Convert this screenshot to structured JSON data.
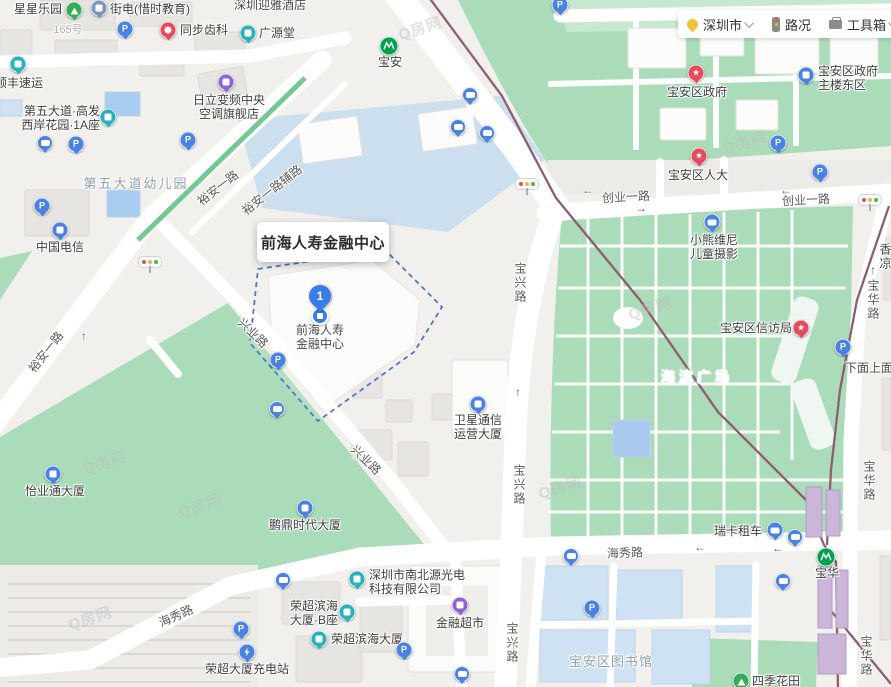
{
  "toolbar": {
    "city": "深圳市",
    "traffic_label": "路况",
    "toolbox_label": "工具箱"
  },
  "popup": {
    "title": "前海人寿金融中心"
  },
  "main_pin": {
    "number": "1",
    "label": [
      "前海人寿",
      "金融中心"
    ]
  },
  "watermark": {
    "text": "Q房网"
  },
  "glyphs": {
    "parking": "P",
    "star": "★"
  },
  "colors": {
    "green": "#35ab58",
    "teal": "#29b0bd",
    "red": "#e84a5c",
    "purple": "#8f63d2",
    "blue": "#4a82e4",
    "slate": "#7e95c2",
    "metro_green": "#00a14e",
    "park": "#abdcba",
    "metro_line": "#8e5d6e",
    "boundary": "#4f78cc",
    "blue_building": "#cfe2f4"
  },
  "metro": [
    {
      "name": "宝安",
      "x": 389,
      "y": 46
    },
    {
      "name": "宝华",
      "x": 826,
      "y": 557
    }
  ],
  "road_labels": [
    {
      "t": "裕安一路",
      "x": 218,
      "y": 188,
      "r": -38
    },
    {
      "t": "裕安一路辅路",
      "x": 272,
      "y": 190,
      "r": -38
    },
    {
      "t": "裕安一路",
      "x": 46,
      "y": 352,
      "r": -52
    },
    {
      "t": "兴业路",
      "x": 253,
      "y": 333,
      "r": 44
    },
    {
      "t": "兴业路",
      "x": 366,
      "y": 460,
      "r": 44
    },
    {
      "t": "宝兴路",
      "x": 520,
      "y": 283,
      "v": 1
    },
    {
      "t": "宝兴路",
      "x": 519,
      "y": 485,
      "v": 1
    },
    {
      "t": "宝兴路",
      "x": 512,
      "y": 643,
      "v": 1
    },
    {
      "t": "创业一路",
      "x": 626,
      "y": 197,
      "r": -3
    },
    {
      "t": "创业一路",
      "x": 806,
      "y": 200,
      "r": -3
    },
    {
      "t": "海秀路",
      "x": 176,
      "y": 616,
      "r": -24
    },
    {
      "t": "海秀路",
      "x": 625,
      "y": 553,
      "r": -2
    },
    {
      "t": "宝华路",
      "x": 873,
      "y": 300,
      "v": 1
    },
    {
      "t": "宝华路",
      "x": 869,
      "y": 481,
      "v": 1
    },
    {
      "t": "宝华路",
      "x": 866,
      "y": 656,
      "v": 1
    },
    {
      "t": "←",
      "x": 588,
      "y": 190
    },
    {
      "t": "←",
      "x": 786,
      "y": 190
    },
    {
      "t": "→",
      "x": 641,
      "y": 208
    },
    {
      "t": "←",
      "x": 700,
      "y": 547
    },
    {
      "t": "←",
      "x": 778,
      "y": 548
    },
    {
      "t": "↑",
      "x": 518,
      "y": 392
    },
    {
      "t": "↑",
      "x": 514,
      "y": 645
    },
    {
      "t": "↑",
      "x": 873,
      "y": 270
    },
    {
      "t": "↑",
      "x": 84,
      "y": 336
    }
  ],
  "area_labels": [
    {
      "t": "深圳迎雅酒店",
      "x": 270,
      "y": 5,
      "size": 12,
      "color": "#4a4a4a"
    },
    {
      "t": "165号",
      "x": 68,
      "y": 30,
      "size": 11,
      "color": "#b3afa9"
    },
    {
      "t": "第五大道幼儿园",
      "x": 136,
      "y": 184,
      "size": 13,
      "color": "#8fa0ad",
      "ls": 2
    },
    {
      "t": "海滨广场",
      "x": 697,
      "y": 377,
      "size": 14,
      "color": "rgba(255,255,255,0.92)",
      "ls": 4
    },
    {
      "t": "宝安区图书馆",
      "x": 611,
      "y": 662,
      "size": 13,
      "color": "#8fa0ad",
      "ls": 1
    },
    {
      "t": "下面上面",
      "x": 869,
      "y": 368,
      "size": 12,
      "color": "#4a4a4a"
    },
    {
      "t": "香凉",
      "x": 885,
      "y": 257,
      "size": 12,
      "color": "#4a4a4a",
      "v": 1
    }
  ],
  "pois": [
    {
      "id": "xingxing-leyuan",
      "type": "green",
      "icon": "tree-icon",
      "x": 74,
      "y": 10,
      "label": [
        "星星乐园"
      ],
      "lx": 62,
      "ly": 9,
      "anchor": "l"
    },
    {
      "id": "jiedian-xishi-jiaoyu",
      "type": "slate",
      "icon": "phone-icon",
      "x": 99,
      "y": 8,
      "label": [
        "街电(惜时教育)"
      ],
      "lx": 110,
      "ly": 9,
      "anchor": "r"
    },
    {
      "id": "tongbu-chike",
      "type": "red",
      "icon": "tooth-icon",
      "x": 168,
      "y": 30,
      "label": [
        "同步齿科"
      ],
      "lx": 180,
      "ly": 30,
      "anchor": "r"
    },
    {
      "id": "shunfeng-suyun",
      "type": "teal",
      "icon": "express-icon",
      "x": 18,
      "y": 64,
      "label": [
        "顺丰速运"
      ],
      "lx": 19,
      "ly": 83
    },
    {
      "id": "hitachi-store",
      "type": "purple",
      "icon": "shop-icon",
      "x": 226,
      "y": 82,
      "label": [
        "日立变频中央",
        "空调旗舰店"
      ],
      "lx": 229,
      "ly": 107
    },
    {
      "id": "diwudadao-gaofa",
      "type": "teal",
      "icon": "building-icon",
      "x": 108,
      "y": 117,
      "label": [
        "第五大道·高发",
        "西岸花园·1A座"
      ],
      "lx": 100,
      "ly": 118,
      "anchor": "l"
    },
    {
      "id": "guangyuantang",
      "type": "teal",
      "icon": "shop-icon",
      "x": 248,
      "y": 33,
      "label": [
        "广源堂"
      ],
      "lx": 259,
      "ly": 33,
      "anchor": "r"
    },
    {
      "id": "zhongguo-dianxin",
      "type": "blue",
      "icon": "building-icon",
      "x": 60,
      "y": 230,
      "label": [
        "中国电信"
      ],
      "lx": 60,
      "ly": 247
    },
    {
      "id": "yiyetong-dasha",
      "type": "blue",
      "icon": "building-icon",
      "x": 53,
      "y": 474,
      "label": [
        "怡业通大厦"
      ],
      "lx": 55,
      "ly": 491
    },
    {
      "id": "pengding-shidai-dasha",
      "type": "blue",
      "icon": "building-icon",
      "x": 305,
      "y": 508,
      "label": [
        "鹏鼎时代大厦"
      ],
      "lx": 305,
      "ly": 525
    },
    {
      "id": "weixing-tongxin-dasha",
      "type": "blue",
      "icon": "building-icon",
      "x": 478,
      "y": 404,
      "label": [
        "卫星通信",
        "运营大厦"
      ],
      "lx": 478,
      "ly": 427
    },
    {
      "id": "xiaoxiong-weini",
      "type": "blue",
      "icon": "camera-icon",
      "x": 712,
      "y": 222,
      "label": [
        "小熊维尼",
        "儿童摄影"
      ],
      "lx": 714,
      "ly": 247
    },
    {
      "id": "baoan-qu-zhengfu",
      "type": "red",
      "icon": "star-icon",
      "x": 696,
      "y": 73,
      "label": [
        "宝安区政府"
      ],
      "lx": 697,
      "ly": 92
    },
    {
      "id": "zhengfu-zhulou-dongqu",
      "type": "blue",
      "icon": "building-icon",
      "x": 806,
      "y": 75,
      "label": [
        "宝安区政府",
        "主楼东区"
      ],
      "lx": 818,
      "ly": 78,
      "anchor": "r"
    },
    {
      "id": "baoan-qu-renda",
      "type": "red",
      "icon": "star-icon",
      "x": 699,
      "y": 156,
      "label": [
        "宝安区人大"
      ],
      "lx": 698,
      "ly": 175
    },
    {
      "id": "baoan-qu-xinfangju",
      "type": "red",
      "icon": "star-icon",
      "x": 801,
      "y": 328,
      "label": [
        "宝安区信访局"
      ],
      "lx": 792,
      "ly": 328,
      "anchor": "l"
    },
    {
      "id": "ruika-zuche",
      "type": "blue",
      "icon": "car-icon",
      "x": 775,
      "y": 530,
      "label": [
        "瑞卡租车"
      ],
      "lx": 762,
      "ly": 531,
      "anchor": "l"
    },
    {
      "id": "jinrong-chaoshi",
      "type": "purple",
      "icon": "shop-icon",
      "x": 460,
      "y": 605,
      "label": [
        "金融超市"
      ],
      "lx": 460,
      "ly": 623
    },
    {
      "id": "nanbeiyuan-guangdian",
      "type": "teal",
      "icon": "building-icon",
      "x": 357,
      "y": 579,
      "label": [
        "深圳市南北源光电",
        "科技有限公司"
      ],
      "lx": 369,
      "ly": 582,
      "anchor": "r"
    },
    {
      "id": "rongchao-binhai-b",
      "type": "teal",
      "icon": "building-icon",
      "x": 347,
      "y": 612,
      "label": [
        "荣超滨海",
        "大厦·B座"
      ],
      "lx": 338,
      "ly": 613,
      "anchor": "l"
    },
    {
      "id": "rongchao-binhai-dasha",
      "type": "teal",
      "icon": "building-icon",
      "x": 319,
      "y": 639,
      "label": [
        "荣超滨海大厦"
      ],
      "lx": 331,
      "ly": 639,
      "anchor": "r"
    },
    {
      "id": "rongchao-chongdianzhan",
      "type": "blue",
      "icon": "charging-icon",
      "x": 247,
      "y": 652,
      "label": [
        "荣超大厦充电站"
      ],
      "lx": 247,
      "ly": 669
    },
    {
      "id": "siji-huatian",
      "type": "green",
      "icon": "tree-icon",
      "x": 741,
      "y": 681,
      "label": [
        "四季花田"
      ],
      "lx": 752,
      "ly": 681,
      "anchor": "r"
    }
  ],
  "parking_markers": [
    [
      125,
      29
    ],
    [
      188,
      140
    ],
    [
      42,
      206
    ],
    [
      278,
      360
    ],
    [
      560,
      5
    ],
    [
      820,
      172
    ],
    [
      778,
      143
    ],
    [
      843,
      347
    ],
    [
      592,
      608
    ],
    [
      404,
      650
    ],
    [
      241,
      629
    ],
    [
      76,
      144
    ]
  ],
  "bus_markers": [
    [
      45,
      143
    ],
    [
      470,
      95
    ],
    [
      458,
      127
    ],
    [
      487,
      133
    ],
    [
      277,
      409
    ],
    [
      283,
      580
    ],
    [
      571,
      556
    ],
    [
      795,
      537
    ],
    [
      783,
      581
    ],
    [
      462,
      674
    ]
  ],
  "traffic_lights": [
    [
      150,
      262
    ],
    [
      527,
      184
    ],
    [
      870,
      200
    ]
  ],
  "watermarks": [
    [
      105,
      462
    ],
    [
      200,
      505
    ],
    [
      560,
      487
    ],
    [
      650,
      308
    ],
    [
      745,
      142
    ],
    [
      420,
      28
    ],
    [
      90,
      618
    ]
  ]
}
